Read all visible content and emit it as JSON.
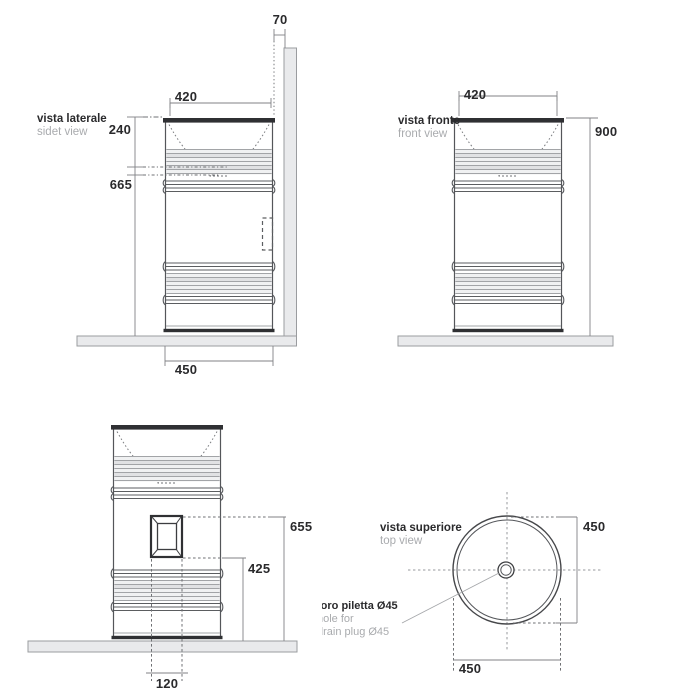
{
  "drawing": {
    "side_view": {
      "title": "vista laterale",
      "subtitle": "sidet view",
      "dim_wall_gap": "70",
      "dim_rim_width": "420",
      "dim_basin_depth": "240",
      "dim_lower_height": "665",
      "dim_floor_width": "450"
    },
    "front_view": {
      "title": "vista fronte",
      "subtitle": "front view",
      "dim_rim_width": "420",
      "dim_total_height": "900"
    },
    "back_view": {
      "dim_opening_top": "655",
      "dim_opening_bottom": "425",
      "dim_opening_width": "120"
    },
    "top_view": {
      "title": "vista superiore",
      "subtitle": "top view",
      "dim_diameter_vertical": "450",
      "dim_diameter_horizontal": "450",
      "drain_note_line1": "foro piletta Ø45",
      "drain_note_line2": "hole for",
      "drain_note_line3": "drain plug  Ø45"
    }
  }
}
